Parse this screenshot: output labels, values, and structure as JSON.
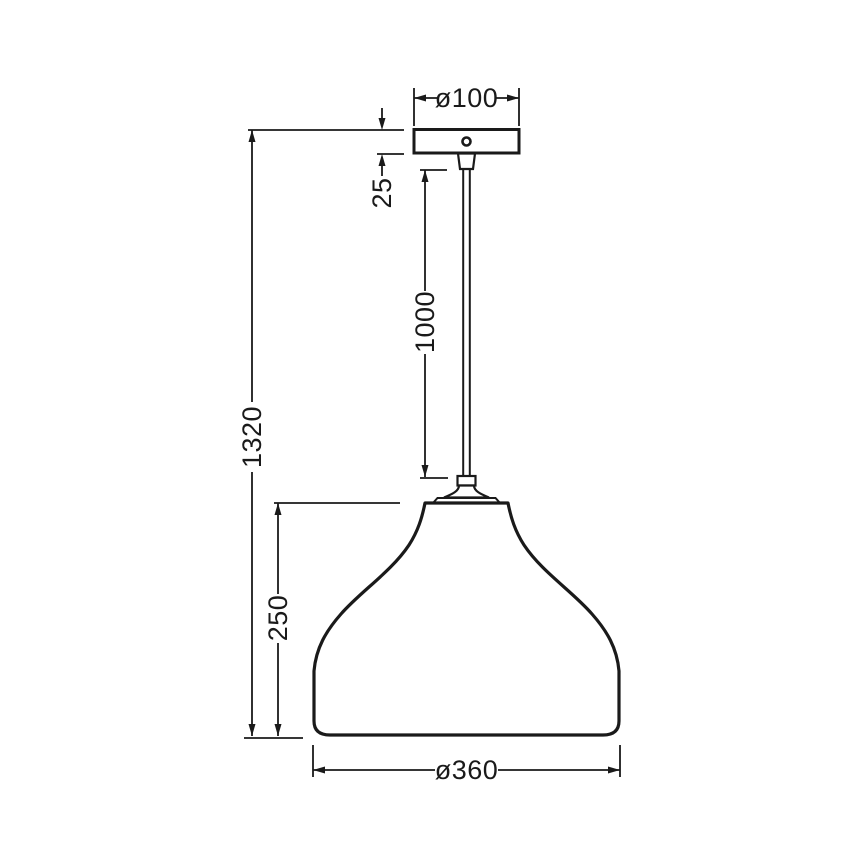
{
  "drawing": {
    "title": "Pendant lamp technical dimension drawing",
    "background_color": "#ffffff",
    "line_color": "#1a1a1a",
    "units_shown": false,
    "dimensions": {
      "canopy_diameter": "ø100",
      "canopy_height": "25",
      "cord_length": "1000",
      "total_height": "1320",
      "shade_height": "250",
      "shade_diameter": "ø360"
    },
    "components": {
      "canopy": "ceiling-canopy",
      "cord": "suspension-cord",
      "shade": "bell-shaped-lamp-shade"
    }
  }
}
